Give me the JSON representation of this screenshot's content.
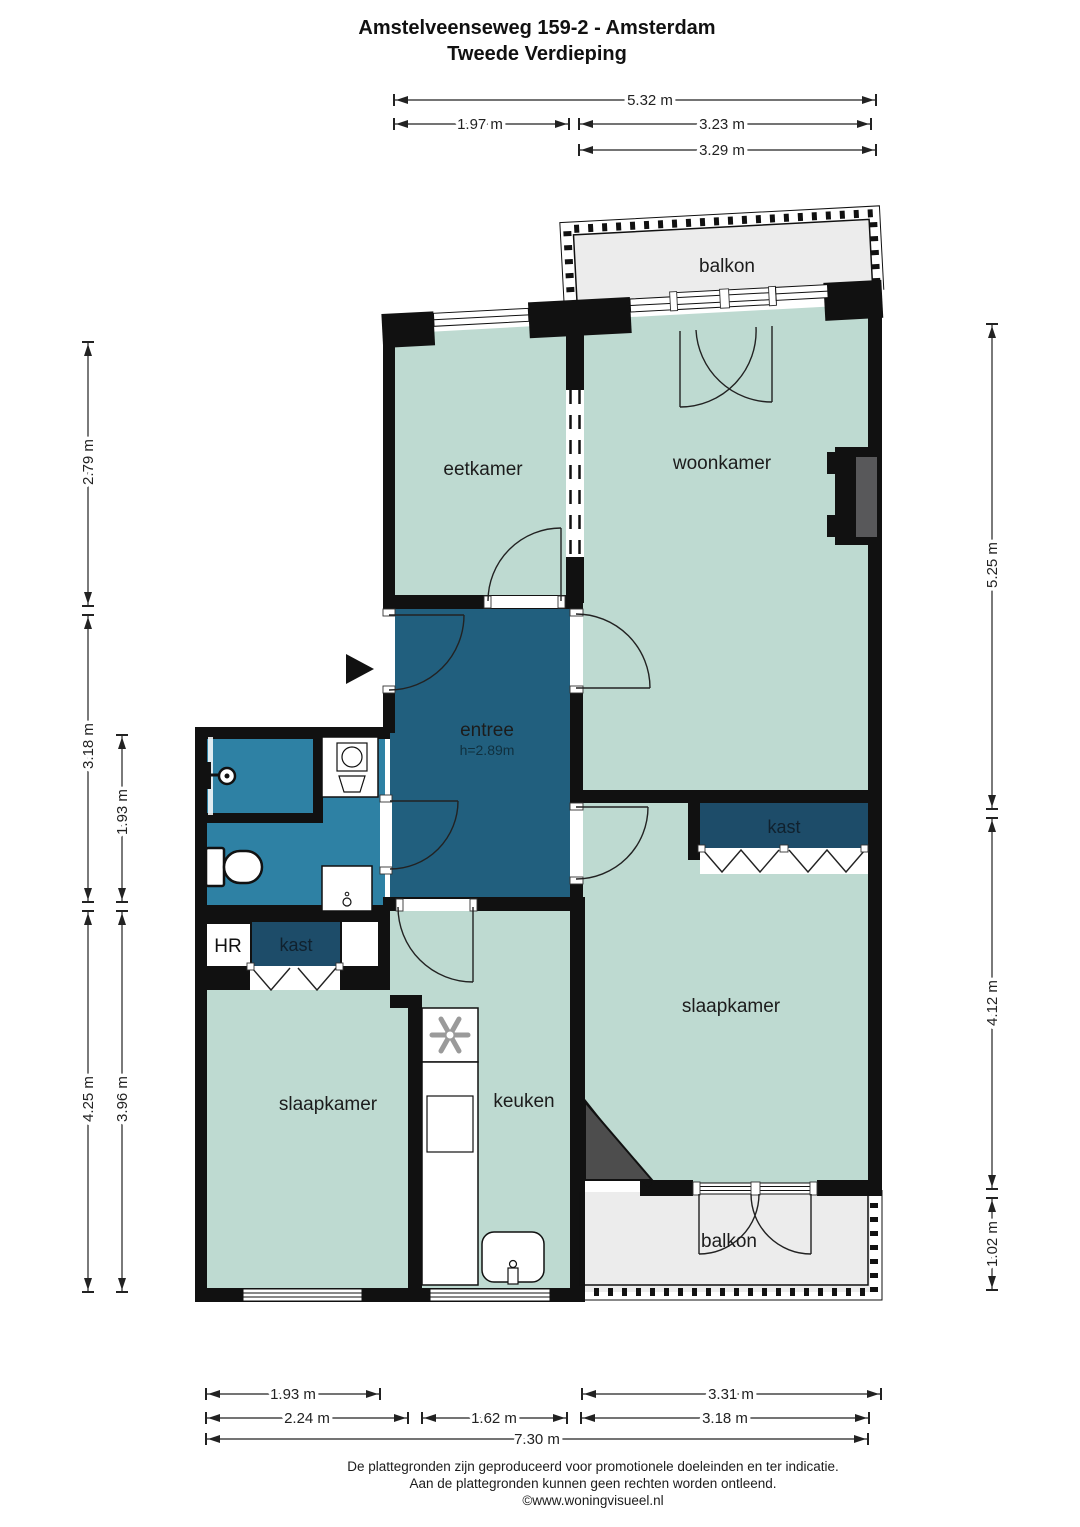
{
  "title": {
    "line1": "Amstelveenseweg 159-2 - Amsterdam",
    "line2": "Tweede Verdieping"
  },
  "rooms": {
    "balkon_top": "balkon",
    "eetkamer": "eetkamer",
    "woonkamer": "woonkamer",
    "entree": "entree",
    "entree_height": "h=2.89m",
    "kast_right": "kast",
    "slaapkamer_right": "slaapkamer",
    "hr": "HR",
    "kast_left": "kast",
    "slaapkamer_left": "slaapkamer",
    "keuken": "keuken",
    "balkon_bottom": "balkon"
  },
  "dimensions": {
    "top": [
      "5.32 m",
      "1.97 m",
      "3.23 m",
      "3.29 m"
    ],
    "left": [
      "2.79 m",
      "3.18 m",
      "4.25 m"
    ],
    "left_inner": [
      "1.93 m",
      "3.96 m"
    ],
    "right": [
      "5.25 m",
      "4.12 m",
      "1.02 m"
    ],
    "bottom_row1": [
      "1.93 m",
      "3.31 m"
    ],
    "bottom_row2": [
      "2.24 m",
      "1.62 m",
      "3.18 m"
    ],
    "bottom_total": "7.30 m"
  },
  "footer": {
    "line1": "De plattegronden zijn geproduceerd voor promotionele doeleinden en ter indicatie.",
    "line2": "Aan de plattegronden kunnen geen rechten worden ontleend.",
    "line3": "©www.woningvisueel.nl"
  },
  "icons": [
    "entrance-arrow-icon",
    "shower-icon",
    "toilet-icon",
    "washing-machine-icon",
    "fixture-icon",
    "stove-icon",
    "sink-icon"
  ],
  "colors": {
    "wall": "#111111",
    "room_green": "#bedad1",
    "entree_blue": "#215f7e",
    "bath_teal": "#2e81a4",
    "closet_navy": "#1d4c69",
    "balcony_grey": "#ececec",
    "dark_grey": "#4d4d4d",
    "chimney_grey": "#58585a",
    "hob_grey": "#9a9a9a"
  }
}
